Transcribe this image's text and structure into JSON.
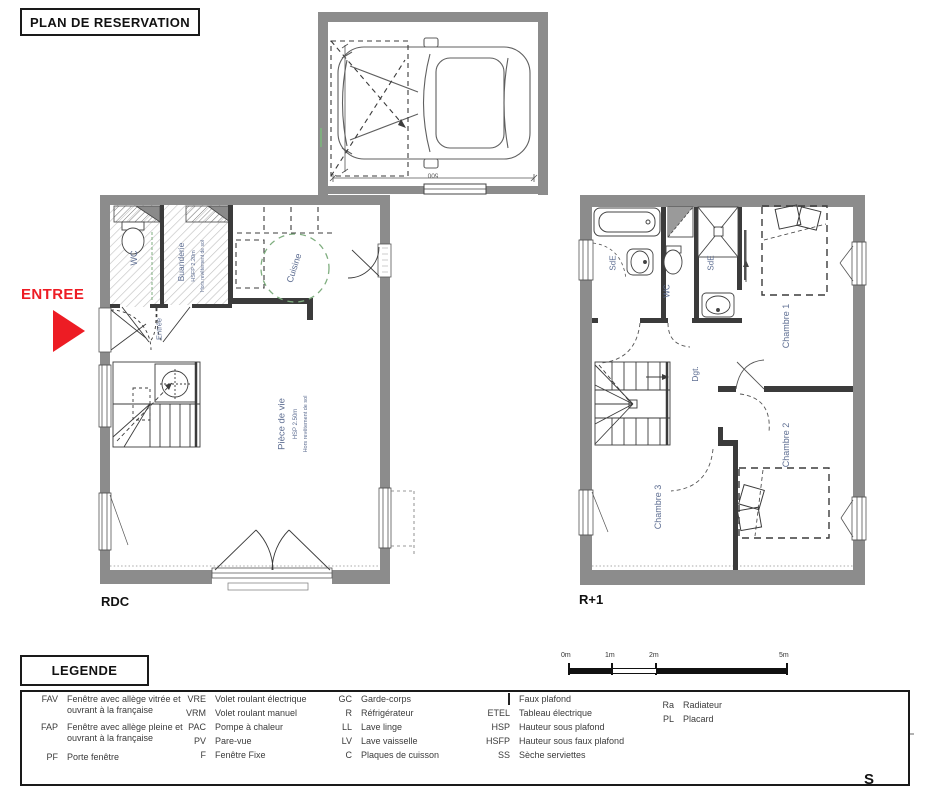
{
  "title": "PLAN DE RESERVATION",
  "entry_marker": "ENTREE",
  "floors": {
    "rdc": {
      "label": "RDC",
      "wc": "WC",
      "buanderie": "Buanderie",
      "buanderie_height": "HSFP 2.20m",
      "buanderie_note": "Hors revêtement de sol",
      "entree": "Entrée",
      "cuisine": "Cuisine",
      "piece_de_vie": "Pièce de vie",
      "piece_height": "HSP 2.50m",
      "piece_note": "Hors revêtement de sol"
    },
    "r1": {
      "label": "R+1",
      "sde_1": "SdE",
      "wc": "WC",
      "sde_2": "SdE",
      "dgt": "Dgt.",
      "chambre_1": "Chambre 1",
      "chambre_2": "Chambre 2",
      "chambre_3": "Chambre 3"
    }
  },
  "garage": {
    "dimension": "500"
  },
  "legend": {
    "title": "LEGENDE",
    "col1": [
      {
        "abbr": "FAV",
        "desc": "Fenêtre avec allège vitrée et ouvrant à la française"
      },
      {
        "abbr": "FAP",
        "desc": "Fenêtre avec allège pleine et ouvrant à la française"
      },
      {
        "abbr": "PF",
        "desc": "Porte fenêtre"
      }
    ],
    "col2": [
      {
        "abbr": "VRE",
        "desc": "Volet roulant électrique"
      },
      {
        "abbr": "VRM",
        "desc": "Volet roulant manuel"
      },
      {
        "abbr": "PAC",
        "desc": "Pompe à chaleur"
      },
      {
        "abbr": "PV",
        "desc": "Pare-vue"
      },
      {
        "abbr": "F",
        "desc": "Fenêtre Fixe"
      }
    ],
    "col3": [
      {
        "abbr": "GC",
        "desc": "Garde-corps"
      },
      {
        "abbr": "R",
        "desc": "Réfrigérateur"
      },
      {
        "abbr": "LL",
        "desc": "Lave linge"
      },
      {
        "abbr": "LV",
        "desc": "Lave vaisselle"
      },
      {
        "abbr": "C",
        "desc": "Plaques de cuisson"
      }
    ],
    "col4": [
      {
        "abbr": "",
        "desc": "Faux plafond"
      },
      {
        "abbr": "ETEL",
        "desc": "Tableau électrique"
      },
      {
        "abbr": "HSP",
        "desc": "Hauteur sous plafond"
      },
      {
        "abbr": "HSFP",
        "desc": "Hauteur sous faux plafond"
      },
      {
        "abbr": "SS",
        "desc": "Sèche serviettes"
      }
    ],
    "col5": [
      {
        "abbr": "Ra",
        "desc": "Radiateur"
      },
      {
        "abbr": "PL",
        "desc": "Placard"
      }
    ]
  },
  "scale_bar": {
    "labels": [
      "0m",
      "1m",
      "2m",
      "5m"
    ]
  },
  "compass": {
    "south": "S"
  },
  "colors": {
    "entry_red": "#ED1C24",
    "wall_gray": "#8C8C8C",
    "room_label_blue": "#5E6E92",
    "cuisine_green": "#7FAE7F"
  }
}
